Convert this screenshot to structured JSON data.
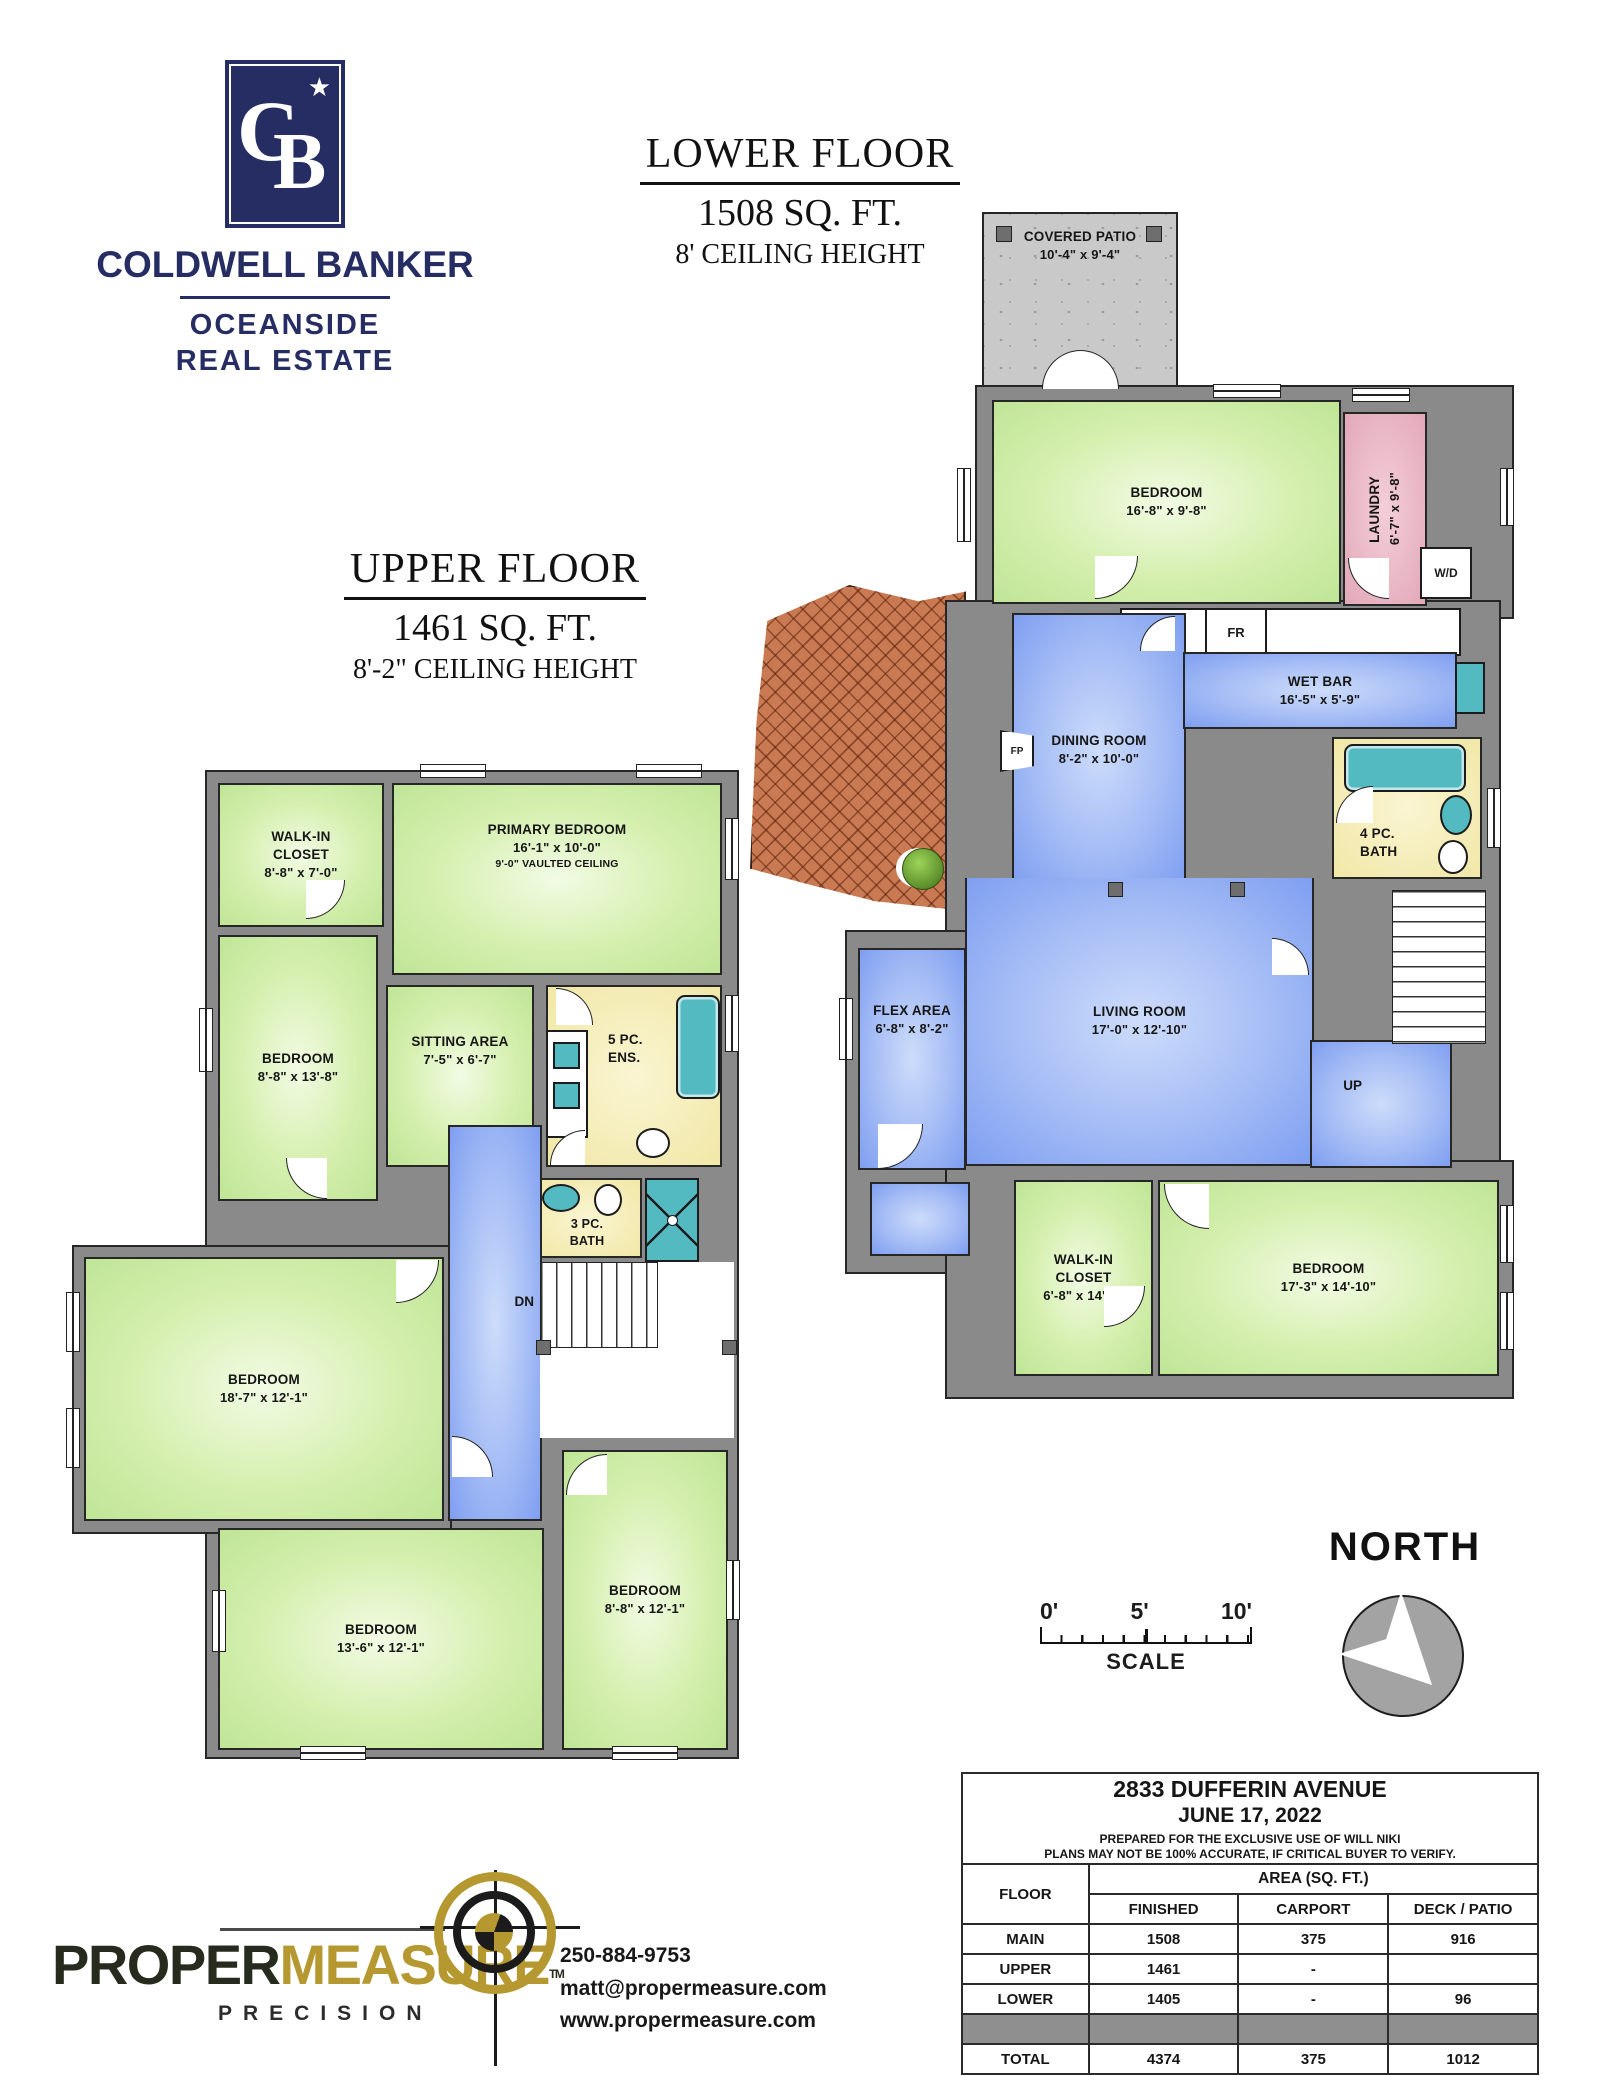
{
  "branding": {
    "monogram_c": "C",
    "monogram_b": "B",
    "star": "★",
    "name": "COLDWELL BANKER",
    "sub1": "OCEANSIDE",
    "sub2": "REAL ESTATE"
  },
  "lower_title": {
    "line1": "LOWER FLOOR",
    "line2": "1508 SQ. FT.",
    "line3": "8' CEILING HEIGHT"
  },
  "upper_title": {
    "line1": "UPPER FLOOR",
    "line2": "1461 SQ. FT.",
    "line3": "8'-2\" CEILING HEIGHT"
  },
  "lower_plan": {
    "patio": {
      "name": "COVERED PATIO",
      "dims": "10'-4\" x 9'-4\""
    },
    "bedroom_top": {
      "name": "BEDROOM",
      "dims": "16'-8\" x 9'-8\""
    },
    "laundry": {
      "name": "LAUNDRY",
      "dims": "6'-7\" x 9'-8\""
    },
    "wd": "W/D",
    "fr": "FR",
    "fp": "FP",
    "up": "UP",
    "dining": {
      "name": "DINING ROOM",
      "dims": "8'-2\" x 10'-0\""
    },
    "wetbar": {
      "name": "WET BAR",
      "dims": "16'-5\" x 5'-9\""
    },
    "bath": {
      "l1": "4 PC.",
      "l2": "BATH"
    },
    "living": {
      "name": "LIVING ROOM",
      "dims": "17'-0\" x 12'-10\""
    },
    "flex": {
      "name": "FLEX AREA",
      "dims": "6'-8\" x 8'-2\""
    },
    "wic": {
      "name": "WALK-IN CLOSET",
      "dims": "6'-8\" x 14'-5\""
    },
    "bedroom_bottom": {
      "name": "BEDROOM",
      "dims": "17'-3\" x 14'-10\""
    }
  },
  "upper_plan": {
    "wic": {
      "name": "WALK-IN CLOSET",
      "dims": "8'-8\" x 7'-0\""
    },
    "primary": {
      "name": "PRIMARY BEDROOM",
      "dims": "16'-1\" x 10'-0\"",
      "note": "9'-0\" VAULTED CEILING"
    },
    "bedroom_left": {
      "name": "BEDROOM",
      "dims": "8'-8\" x 13'-8\""
    },
    "sitting": {
      "name": "SITTING AREA",
      "dims": "7'-5\" x 6'-7\""
    },
    "ensuite": {
      "l1": "5 PC.",
      "l2": "ENS."
    },
    "bath": {
      "l1": "3 PC.",
      "l2": "BATH"
    },
    "dn": "DN",
    "bedroom_big": {
      "name": "BEDROOM",
      "dims": "18'-7\" x 12'-1\""
    },
    "bedroom_13": {
      "name": "BEDROOM",
      "dims": "13'-6\" x 12'-1\""
    },
    "bedroom_8": {
      "name": "BEDROOM",
      "dims": "8'-8\" x 12'-1\""
    }
  },
  "north": {
    "label": "NORTH"
  },
  "scale_bar": {
    "t0": "0'",
    "t5": "5'",
    "t10": "10'",
    "label": "SCALE"
  },
  "info_table": {
    "address": "2833 DUFFERIN AVENUE",
    "date": "JUNE 17, 2022",
    "prepared": "PREPARED FOR THE EXCLUSIVE USE OF WILL NIKI",
    "disclaimer": "PLANS MAY NOT BE 100% ACCURATE, IF CRITICAL BUYER TO VERIFY.",
    "col_floor": "FLOOR",
    "col_area": "AREA (SQ. FT.)",
    "col_finished": "FINISHED",
    "col_carport": "CARPORT",
    "col_deck": "DECK / PATIO",
    "rows": [
      {
        "floor": "MAIN",
        "finished": "1508",
        "carport": "375",
        "deck": "916"
      },
      {
        "floor": "UPPER",
        "finished": "1461",
        "carport": "-",
        "deck": ""
      },
      {
        "floor": "LOWER",
        "finished": "1405",
        "carport": "-",
        "deck": "96"
      }
    ],
    "total": {
      "floor": "TOTAL",
      "finished": "4374",
      "carport": "375",
      "deck": "1012"
    }
  },
  "pm": {
    "word1": "PROPER",
    "word2": "MEASURE",
    "tm": "TM",
    "word3": "PRECISION",
    "phone": "250-884-9753",
    "email": "matt@propermeasure.com",
    "web": "www.propermeasure.com"
  },
  "colors": {
    "brand_navy": "#252d63",
    "gold": "#b5982f",
    "wall_gray": "#8a8a8a",
    "room_green": "#c8e9a4",
    "room_blue": "#8fa9f0",
    "room_yellow": "#f3ecae",
    "room_pink": "#e9b7c4",
    "fixture_teal": "#53bac2",
    "concrete": "#c9c9c9",
    "brick": "#c97a52"
  }
}
